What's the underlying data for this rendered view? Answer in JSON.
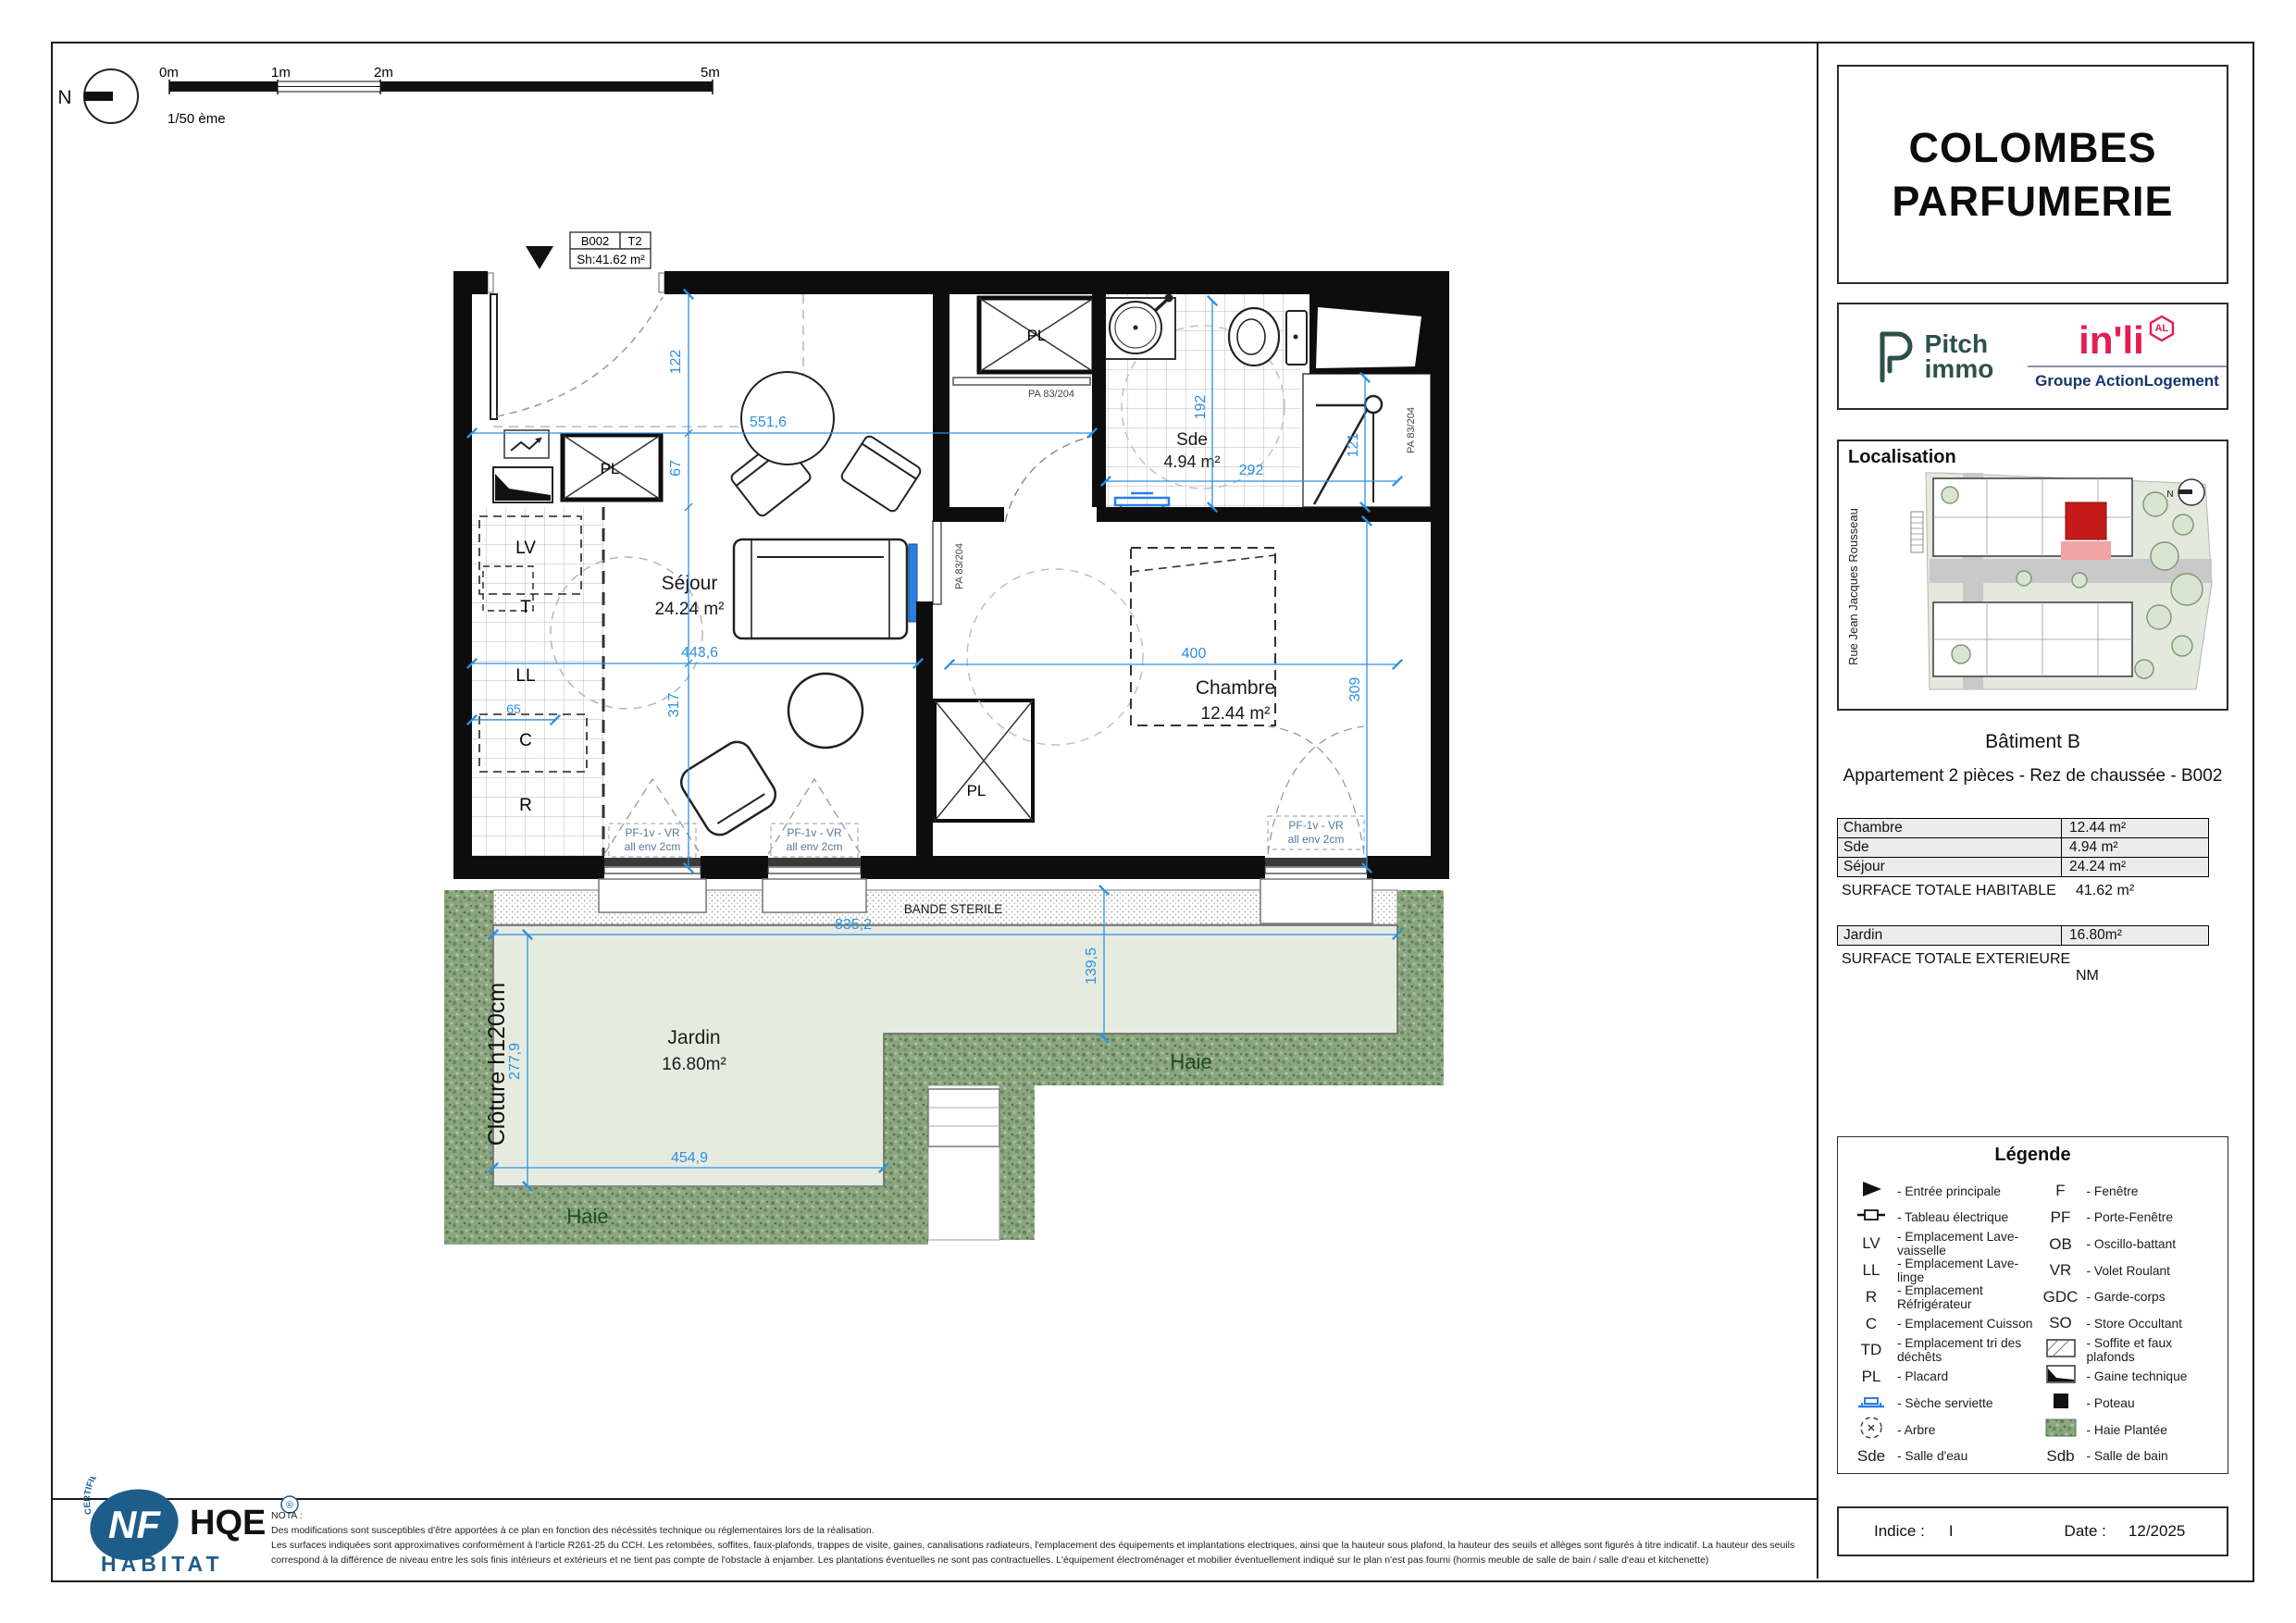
{
  "scalebar": {
    "t0": "0m",
    "t1": "1m",
    "t2": "2m",
    "t5": "5m",
    "scale": "1/50 ème",
    "north": "N"
  },
  "unit_tag": {
    "code": "B002",
    "type": "T2",
    "sh": "Sh:41.62 m²"
  },
  "plan": {
    "labels": {
      "pl": "PL"
    },
    "kitchen": {
      "lv": "LV",
      "t": "T",
      "ll": "LL",
      "c": "C",
      "r": "R"
    },
    "rooms": {
      "sejour": {
        "name": "Séjour",
        "area": "24.24 m²"
      },
      "chambre": {
        "name": "Chambre",
        "area": "12.44 m²"
      },
      "sde": {
        "name": "Sde",
        "area": "4.94 m²"
      },
      "jardin": {
        "name": "Jardin",
        "area": "16.80m²"
      }
    },
    "dims": {
      "d122": "122",
      "d67": "67",
      "d5516": "551,6",
      "d4436": "443,6",
      "d317": "317",
      "d65": "65",
      "d192": "192",
      "d292": "292",
      "d121": "121",
      "d400": "400",
      "d309": "309",
      "d8352": "835,2",
      "d2779": "277,9",
      "d4549": "454,9",
      "d1395": "139,5"
    },
    "doors": {
      "pa": "PA 83/204"
    },
    "windows": {
      "pf": "PF-1v - VR",
      "allege": "all env 2cm"
    },
    "garden": {
      "bande": "BANDE STERILE",
      "cloture": "Clôture h120cm",
      "haie": "Haie"
    }
  },
  "panel": {
    "title_line1": "COLOMBES",
    "title_line2": "PARFUMERIE",
    "logos": {
      "pitch_line1": "Pitch",
      "pitch_line2": "immo",
      "inli": "in'li",
      "inli_badge": "AL",
      "inli_sub": "Groupe ActionLogement"
    },
    "localisation": {
      "title": "Localisation",
      "street": "Rue Jean Jacques Rousseau",
      "north": "N"
    },
    "batiment": "Bâtiment B",
    "appartement": "Appartement 2 pièces - Rez de chaussée - B002",
    "surface_rows": [
      {
        "label": "Chambre",
        "value": "12.44 m²"
      },
      {
        "label": "Sde",
        "value": "4.94 m²"
      },
      {
        "label": "Séjour",
        "value": "24.24 m²"
      }
    ],
    "total_habitable_label": "SURFACE TOTALE HABITABLE",
    "total_habitable_value": "41.62  m²",
    "jardin_row": {
      "label": "Jardin",
      "value": "16.80m²"
    },
    "total_exterieure_label": "SURFACE TOTALE EXTERIEURE",
    "total_exterieure_value": "NM",
    "indice_label": "Indice :",
    "indice_value": "I",
    "date_label": "Date :",
    "date_value": "12/2025"
  },
  "legend": {
    "title": "Légende",
    "left": [
      {
        "abbr": "",
        "label": "- Entrée principale"
      },
      {
        "abbr": "",
        "label": "- Tableau électrique"
      },
      {
        "abbr": "LV",
        "label": "- Emplacement Lave-vaisselle"
      },
      {
        "abbr": "LL",
        "label": "- Emplacement Lave-linge"
      },
      {
        "abbr": "R",
        "label": "- Emplacement Réfrigérateur"
      },
      {
        "abbr": "C",
        "label": "- Emplacement Cuisson"
      },
      {
        "abbr": "TD",
        "label": "- Emplacement tri des déchêts"
      },
      {
        "abbr": "PL",
        "label": "- Placard"
      },
      {
        "abbr": "",
        "label": "- Sèche serviette"
      },
      {
        "abbr": "",
        "label": "- Arbre"
      },
      {
        "abbr": "Sde",
        "label": "- Salle d'eau"
      }
    ],
    "right": [
      {
        "abbr": "F",
        "label": "- Fenêtre"
      },
      {
        "abbr": "PF",
        "label": "- Porte-Fenêtre"
      },
      {
        "abbr": "OB",
        "label": "- Oscillo-battant"
      },
      {
        "abbr": "VR",
        "label": "- Volet Roulant"
      },
      {
        "abbr": "GDC",
        "label": "- Garde-corps"
      },
      {
        "abbr": "SO",
        "label": "- Store Occultant"
      },
      {
        "abbr": "",
        "label": "- Soffite et faux plafonds"
      },
      {
        "abbr": "",
        "label": "- Gaine technique"
      },
      {
        "abbr": "",
        "label": "- Poteau"
      },
      {
        "abbr": "",
        "label": "- Haie Plantée"
      },
      {
        "abbr": "Sdb",
        "label": "- Salle de bain"
      }
    ]
  },
  "nota": {
    "title": "NOTA :",
    "line1": "Des modifications sont susceptibles d'être apportées à ce plan en fonction des nécéssités technique ou réglementaires lors de la réalisation.",
    "line2": "Les surfaces indiquées sont approximatives conformément à l'article R261-25 du CCH. Les retombées, soffites, faux-plafonds, trappes de visite, gaines, canalisations radiateurs, l'emplacement des équipements et implantations electriques, ainsi que la hauteur sous plafond, la hauteur des seuils et allèges sont figurés à titre indicatif. La hauteur des seuils",
    "line3": "correspond à la différence de niveau entre les sols finis intérieurs et extérieurs et ne tient pas compte de l'obstacle à enjamber. Les plantations éventuelles ne sont pas contractuelles. L'équipement électroménager et mobilier éventuellement indiqué sur le plan n'est pas fourni (hormis meuble de salle de bain / salle d'eau et kitchenette)"
  },
  "nf_logo": {
    "cert": "CERTIFIÉ PAR CÉQUAMI",
    "nf": "NF",
    "hqe": "HQE",
    "r": "®",
    "habitat": "HABITAT"
  },
  "colors": {
    "dim_blue": "#2d90e0",
    "inli_pink": "#e31d53",
    "al_blue": "#16356c",
    "pitch_green": "#2f4f4a",
    "nf_blue": "#1e5c8a",
    "hedge_green": "#8ba681",
    "lawn_green": "#e6ebe0",
    "unit_red": "#c51a1a"
  }
}
